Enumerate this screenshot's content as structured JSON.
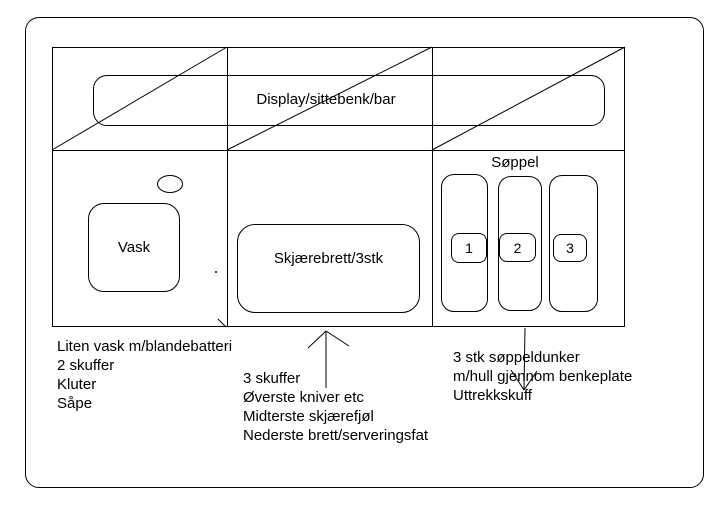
{
  "colors": {
    "background": "#ffffff",
    "line": "#000000"
  },
  "slide": {
    "counter_top": {
      "label": "Display/sittebenk/bar"
    },
    "sink_unit": {
      "label": "Vask"
    },
    "cutting_unit": {
      "label": "Skjærebrett/3stk"
    },
    "waste_unit": {
      "label": "Søppel",
      "bins": [
        {
          "number": "1"
        },
        {
          "number": "2"
        },
        {
          "number": "3"
        }
      ]
    },
    "notes": {
      "sink": {
        "lines": [
          "Liten vask m/blandebatteri",
          "2 skuffer",
          "Kluter",
          "Såpe"
        ]
      },
      "drawers": {
        "lines": [
          "3 skuffer",
          "Øverste kniver etc",
          "Midterste skjærefjøl",
          "Nederste brett/serveringsfat"
        ]
      },
      "waste": {
        "lines": [
          "3 stk søppeldunker",
          "m/hull gjennom benkeplate",
          "Uttrekkskuff"
        ]
      }
    }
  }
}
